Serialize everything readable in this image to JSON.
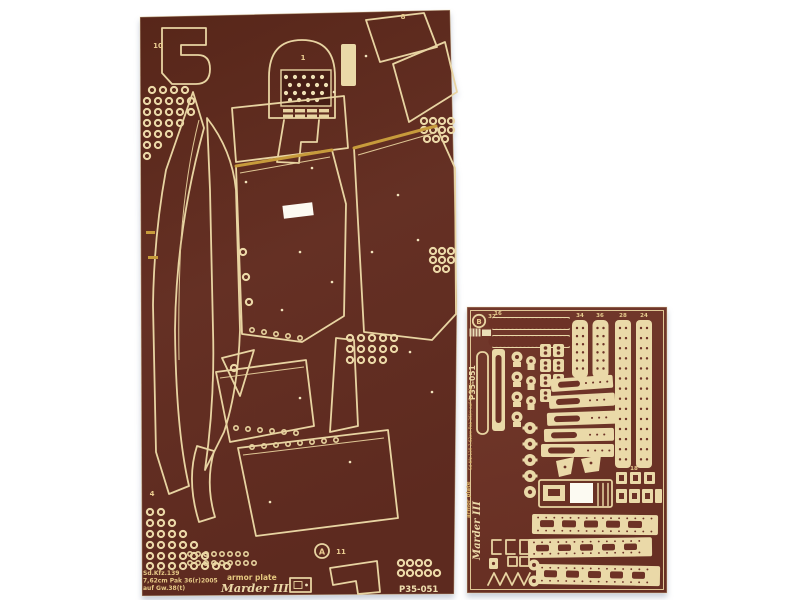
{
  "colors": {
    "background": "#ffffff",
    "left_sheet_bg": "#5e2b20",
    "right_sheet_bg": "#6d3226",
    "etch_cream": "#ead9a8",
    "brass_gold": "#c79b3b"
  },
  "left_sheet": {
    "part_labels": {
      "top_left": "10",
      "top_center": "1",
      "top_right": "8",
      "bottom_left": "4",
      "bottom_center": "11",
      "stamp_letter": "A"
    },
    "footer": {
      "vehicle_line1": "Sd.Kfz.139",
      "vehicle_line2": "7,62cm Pak 36(r)",
      "vehicle_line3": "auf Gw.38(t)",
      "year": "2005",
      "set_type": "armor plate",
      "vehicle_name": "Marder III",
      "set_code": "P35-051"
    }
  },
  "right_sheet": {
    "logo_letter": "B",
    "part_labels": {
      "n32": "32",
      "n16": "16",
      "n34": "34",
      "n36": "36",
      "n28": "28",
      "n24": "24",
      "n18": "18"
    },
    "side_text": {
      "set_code": "P35-051",
      "vehicle_line": "Sd.Kfz.139 7,62cm Pak 36(r) auf Gw.38(t)",
      "set_type": "armor plate",
      "vehicle_name": "Marder III"
    }
  }
}
